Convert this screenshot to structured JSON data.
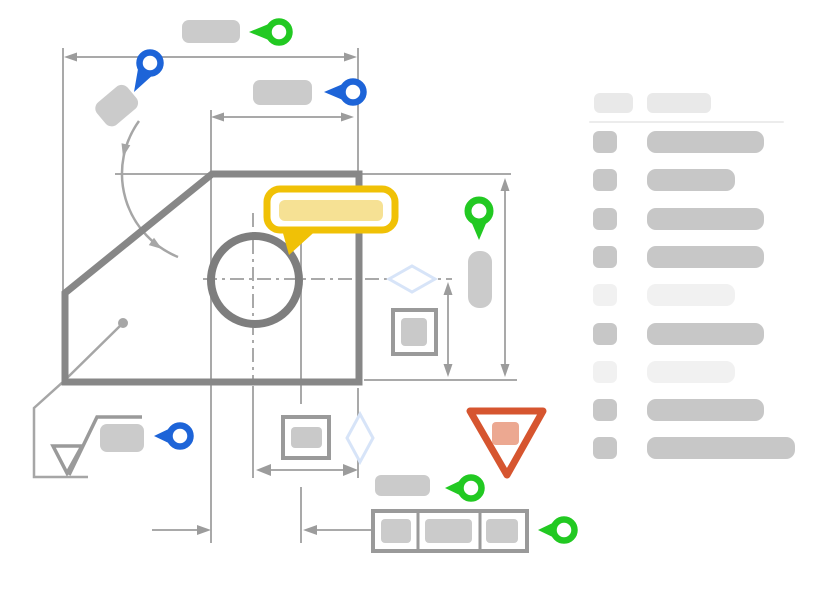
{
  "title": "drawing-review-annotation-wireframe",
  "colors": {
    "pin_green": "#22c922",
    "pin_blue": "#1d64d8",
    "note_yellow": "#f0c106",
    "note_yellow_fill": "#f6e194",
    "warning_red": "#d6552f",
    "warning_red_fill": "#ecа891",
    "warning_fill": "#eca891",
    "part_gray": "#878787",
    "circle_gray": "#7e7e7e",
    "line_gray": "#a9a9a9",
    "arrow_gray": "#9c9c9c",
    "box_gray": "#9a9a9a",
    "placeholder_gray": "#cbcbcb",
    "diamond_blue": "#d7e4f8",
    "row_dark": "#c7c7c7",
    "row_light": "#f1f1f1",
    "header_gray": "#e9e9e9",
    "divider_gray": "#ececec",
    "white": "#ffffff"
  },
  "icons": {
    "pin_left": "map pin pointing left (ring + tail)",
    "pin_down": "map pin pointing down (ring + tail)",
    "pin_diag": "map pin pointing down-left (ring + tail)",
    "comment_bubble": "speech bubble with text placeholder",
    "warning_triangle": "inverted triangle alert",
    "surface_finish": "surface-finish check symbol",
    "feature_control_frame": "3-cell GD&T frame",
    "diamond": "diamond node",
    "dimension_arrow": "double-headed dimension line"
  },
  "drawing": {
    "annotations": [
      {
        "id": "pin-top",
        "icon": "pin_left",
        "color": "green"
      },
      {
        "id": "pin-upper-left",
        "icon": "pin_diag",
        "color": "blue"
      },
      {
        "id": "pin-top-right",
        "icon": "pin_left",
        "color": "blue"
      },
      {
        "id": "pin-mid-right",
        "icon": "pin_down",
        "color": "green"
      },
      {
        "id": "pin-bottom-left",
        "icon": "pin_left",
        "color": "blue"
      },
      {
        "id": "pin-bottom-mid",
        "icon": "pin_left",
        "color": "green"
      },
      {
        "id": "pin-frame",
        "icon": "pin_left",
        "color": "green"
      },
      {
        "id": "comment-bubble",
        "icon": "comment_bubble",
        "color": "yellow"
      },
      {
        "id": "warning-marker",
        "icon": "warning_triangle",
        "color": "red"
      }
    ]
  },
  "sidebar": {
    "header": {
      "pills": [
        {
          "x": 5,
          "y": 5,
          "w": 39,
          "h": 20
        },
        {
          "x": 58,
          "y": 5,
          "w": 64,
          "h": 20
        }
      ]
    },
    "rows": [
      {
        "tone": "dark",
        "bar_width": 117
      },
      {
        "tone": "dark",
        "bar_width": 88
      },
      {
        "tone": "dark",
        "bar_width": 117
      },
      {
        "tone": "dark",
        "bar_width": 117
      },
      {
        "tone": "muted",
        "bar_width": 88
      },
      {
        "tone": "dark",
        "bar_width": 117
      },
      {
        "tone": "muted",
        "bar_width": 88
      },
      {
        "tone": "dark",
        "bar_width": 117
      },
      {
        "tone": "dark",
        "bar_width": 148
      }
    ]
  }
}
